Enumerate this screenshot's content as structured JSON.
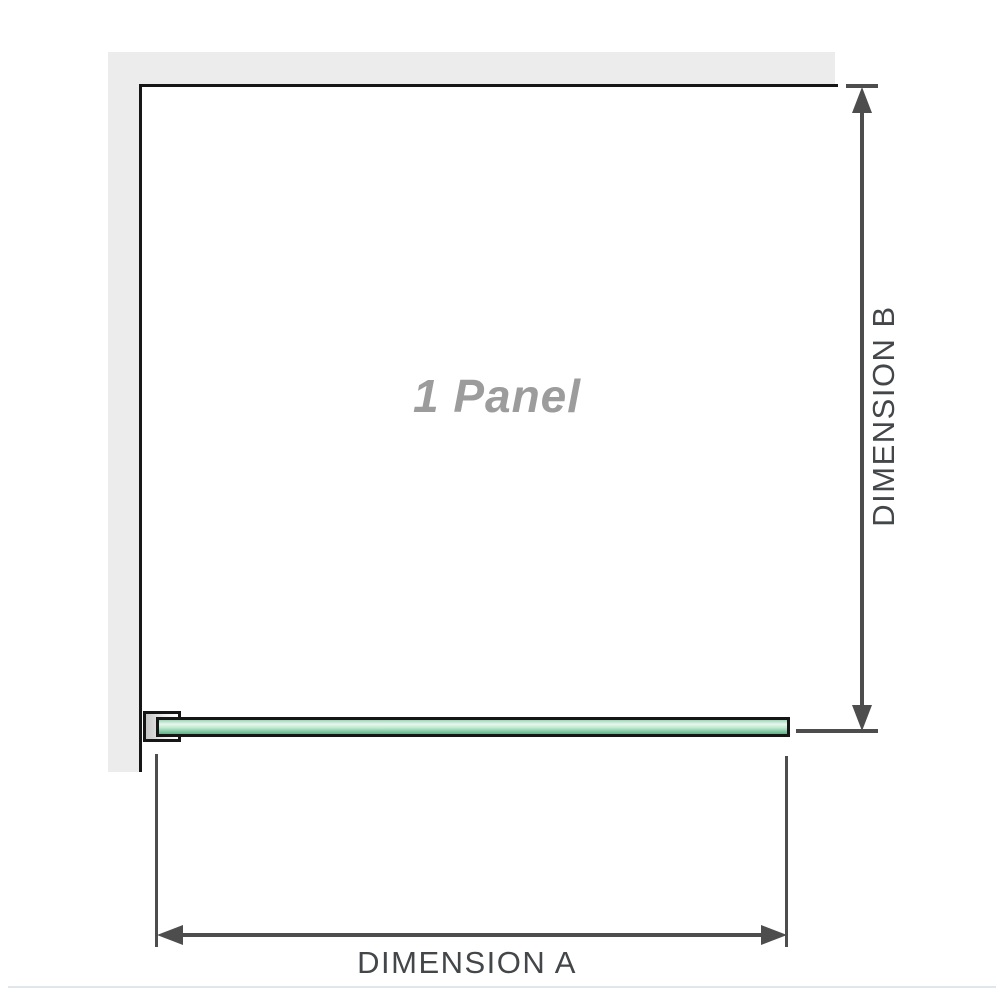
{
  "diagram": {
    "panel_label": "1 Panel",
    "dimension_a_label": "DIMENSION A",
    "dimension_b_label": "DIMENSION B"
  },
  "icons": {
    "arrow_up": "dimension-arrow-up",
    "arrow_down": "dimension-arrow-down",
    "arrow_left": "dimension-arrow-left",
    "arrow_right": "dimension-arrow-right"
  },
  "colors": {
    "wall": "#ececec",
    "outline": "#161616",
    "dimension": "#4d4d4d",
    "label-text": "#43474a",
    "panel-label-text": "#9c9c9c",
    "glass-light": "#e6f7ee",
    "glass-mid": "#9bd6b4",
    "glass-dark": "#7cc49d",
    "baseline-rule": "#dfe6ec"
  }
}
